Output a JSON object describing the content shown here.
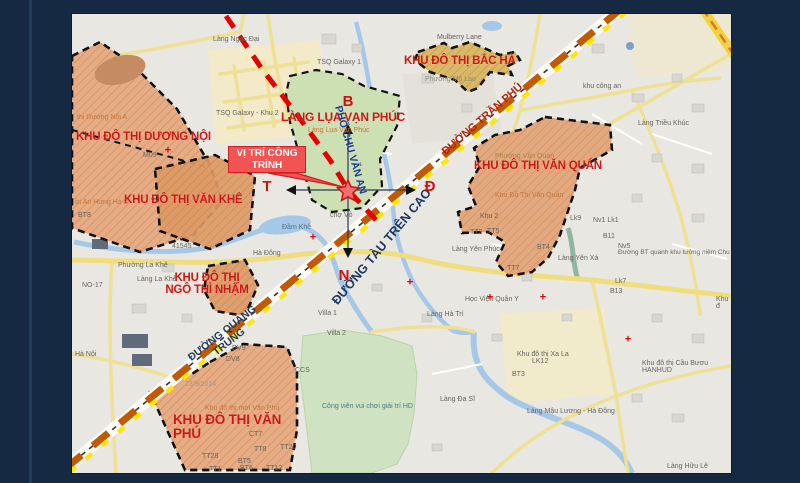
{
  "slide": {
    "background_color": "#152a42"
  },
  "map": {
    "base_color": "#e9e7e1",
    "zone_fill": "#e5a87e",
    "zone_fill_dark": "#dd9a66",
    "bacha_fill": "#d9b55e",
    "green_zone_fill": "#cde0b4",
    "highway_orange": "#c25a04",
    "highway_yellow": "#ffe60a",
    "red_road": "#e60000",
    "water": "#a6c8e8"
  },
  "callout": {
    "line1": "VỊ TRÍ CÔNG",
    "line2": "TRÌNH",
    "bg": "#f25353",
    "border": "#cf1f1f"
  },
  "compass": [
    {
      "text": "B",
      "x": 276,
      "y": 88
    },
    {
      "text": "T",
      "x": 195,
      "y": 173
    },
    {
      "text": "Đ",
      "x": 358,
      "y": 173
    },
    {
      "text": "N",
      "x": 272,
      "y": 262
    }
  ],
  "zone_labels": [
    {
      "name": "zone-label-duong-noi",
      "text": "KHU ĐÔ THỊ DƯƠNG NỘI",
      "x": 4,
      "y": 117
    },
    {
      "name": "zone-label-van-khe",
      "text": "KHU ĐÔ THỊ VĂN KHÊ",
      "x": 52,
      "y": 180
    },
    {
      "name": "zone-label-ngo-thi-nham",
      "text": "KHU ĐÔ THỊ\nNGÔ THÌ NHẬM",
      "x": 85,
      "y": 258,
      "w": 100,
      "align": "center"
    },
    {
      "name": "zone-label-van-phu",
      "text": "KHU ĐÔ THỊ VĂN\nPHÚ",
      "x": 101,
      "y": 399,
      "size": 13.5
    },
    {
      "name": "zone-label-lang-lua-van-phuc",
      "text": "LÀNG LỤA VẠN PHÚC",
      "x": 209,
      "y": 97,
      "size": 12
    },
    {
      "name": "zone-label-bac-ha",
      "text": "KHU ĐÔ THỊ BẮC HÀ",
      "x": 332,
      "y": 41
    },
    {
      "name": "zone-label-van-quan",
      "text": "KHU ĐÔ THỊ VĂN QUÁN",
      "x": 402,
      "y": 146
    }
  ],
  "road_labels": [
    {
      "name": "road-label-tran-phu",
      "text": "ĐƯỜNG TRẦN PHÚ",
      "x": 411,
      "y": 106,
      "rotate": -41,
      "color": "#b3220f",
      "size": 11
    },
    {
      "name": "road-label-tau-tren-cao",
      "text": "ĐƯỜNG TÀU TRÊN CAO",
      "x": 310,
      "y": 233,
      "rotate": -50,
      "color": "#1c3668",
      "size": 12.5
    },
    {
      "name": "road-label-quang-trung",
      "text": "ĐƯỜNG QUANG\nTRUNG",
      "x": 154,
      "y": 324,
      "rotate": -38,
      "color": "#233a5e",
      "size": 10.5
    },
    {
      "name": "road-label-chu-van-an",
      "text": "PHỐ CHU VĂN AN",
      "x": 278,
      "y": 136,
      "rotate": 74,
      "color": "#1d3f94",
      "size": 10.5
    }
  ],
  "place_labels": [
    {
      "text": "Làng Ngọc Đại",
      "x": 141,
      "y": 22
    },
    {
      "text": "Mulberry Lane",
      "x": 365,
      "y": 20
    },
    {
      "text": "TSQ Galaxy 1",
      "x": 245,
      "y": 45
    },
    {
      "text": "TSQ Galaxy - Khu 2",
      "x": 144,
      "y": 96
    },
    {
      "text": "Phường Mộ Lao",
      "x": 353,
      "y": 62,
      "color": "#8a8a80"
    },
    {
      "text": "khu công an",
      "x": 511,
      "y": 69
    },
    {
      "text": "Làng Triều Khúc",
      "x": 566,
      "y": 106
    },
    {
      "text": "thị Dương Nội A",
      "x": 5,
      "y": 100,
      "color": "#c4763a"
    },
    {
      "text": "M09",
      "x": 71,
      "y": 138
    },
    {
      "text": "ời An Hưng Hà Đ",
      "x": 3,
      "y": 185,
      "color": "#c4763a"
    },
    {
      "text": "BT8",
      "x": 6,
      "y": 198
    },
    {
      "text": "41545",
      "x": 100,
      "y": 229
    },
    {
      "text": "Phường La Khê",
      "x": 46,
      "y": 248
    },
    {
      "text": "Làng La Khê",
      "x": 65,
      "y": 262
    },
    {
      "text": "NO-17",
      "x": 10,
      "y": 268
    },
    {
      "text": "Hà Đông",
      "x": 181,
      "y": 236
    },
    {
      "text": "Đầm Khê",
      "x": 210,
      "y": 210,
      "color": "#56718a"
    },
    {
      "text": "chợ Vồ",
      "x": 258,
      "y": 198
    },
    {
      "text": "Hà Nội",
      "x": 3,
      "y": 337
    },
    {
      "text": "23/9/2014",
      "x": 113,
      "y": 367,
      "color": "#9a9a94"
    },
    {
      "text": "Villa 1",
      "x": 246,
      "y": 296
    },
    {
      "text": "Villa 2",
      "x": 255,
      "y": 316
    },
    {
      "text": "CCS",
      "x": 223,
      "y": 353
    },
    {
      "text": "DV9",
      "x": 160,
      "y": 331
    },
    {
      "text": "DV8",
      "x": 154,
      "y": 342
    },
    {
      "text": "Khu đô thị mới Văn Phú",
      "x": 133,
      "y": 391,
      "color": "#c4763a"
    },
    {
      "text": "CT7",
      "x": 177,
      "y": 417
    },
    {
      "text": "TT8",
      "x": 182,
      "y": 432
    },
    {
      "text": "TT20",
      "x": 208,
      "y": 430
    },
    {
      "text": "TT28",
      "x": 130,
      "y": 439
    },
    {
      "text": "BT5",
      "x": 166,
      "y": 444
    },
    {
      "text": "BT6",
      "x": 168,
      "y": 451
    },
    {
      "text": "TT12",
      "x": 194,
      "y": 451
    },
    {
      "text": "TT1",
      "x": 137,
      "y": 452
    },
    {
      "text": "Công viên vui chơi giải trí HD",
      "x": 250,
      "y": 389,
      "color": "#4a7a8c"
    },
    {
      "text": "Làng Đa Sĩ",
      "x": 368,
      "y": 382
    },
    {
      "text": "Khu đô thị Xa La",
      "x": 445,
      "y": 337
    },
    {
      "text": "LK12",
      "x": 460,
      "y": 344
    },
    {
      "text": "BT3",
      "x": 440,
      "y": 357
    },
    {
      "text": "Khu đô thị Cầu Bươu HANHUD",
      "x": 570,
      "y": 346
    },
    {
      "text": "Làng Mậu Lương - Hà Đông",
      "x": 455,
      "y": 394
    },
    {
      "text": "Làng Hữu Lê",
      "x": 595,
      "y": 449
    },
    {
      "text": "Học Viện Quân Y",
      "x": 393,
      "y": 282
    },
    {
      "text": "Làng Hà Trì",
      "x": 355,
      "y": 297
    },
    {
      "text": "Làng Yên Phúc",
      "x": 380,
      "y": 232
    },
    {
      "text": "Làng Yên Xá",
      "x": 486,
      "y": 241
    },
    {
      "text": "Lk9",
      "x": 498,
      "y": 201
    },
    {
      "text": "Nv1  Lk1",
      "x": 521,
      "y": 203
    },
    {
      "text": "B11",
      "x": 531,
      "y": 219
    },
    {
      "text": "Nv5",
      "x": 546,
      "y": 229
    },
    {
      "text": "Đường BT quanh khu tưởng niệm Chu",
      "x": 546,
      "y": 236,
      "size": 6.5
    },
    {
      "text": "Lk7",
      "x": 543,
      "y": 264
    },
    {
      "text": "B13",
      "x": 538,
      "y": 274
    },
    {
      "text": "Khu đ",
      "x": 644,
      "y": 282
    },
    {
      "text": "Phường Văn Quán",
      "x": 423,
      "y": 139,
      "color": "#b08048"
    },
    {
      "text": "Khu Đô Thị Văn Quán",
      "x": 423,
      "y": 178,
      "color": "#c4763a"
    },
    {
      "text": "Khu 2",
      "x": 408,
      "y": 199
    },
    {
      "text": "TT3",
      "x": 398,
      "y": 215
    },
    {
      "text": "TT5",
      "x": 415,
      "y": 214
    },
    {
      "text": "BT4",
      "x": 465,
      "y": 230
    },
    {
      "text": "TT7",
      "x": 435,
      "y": 251
    },
    {
      "text": "Làng Lụa Vạn Phúc",
      "x": 236,
      "y": 113,
      "color": "#c4763a"
    }
  ],
  "crosses": [
    {
      "x": 96,
      "y": 137
    },
    {
      "x": 241,
      "y": 224
    },
    {
      "x": 338,
      "y": 269
    },
    {
      "x": 418,
      "y": 284
    },
    {
      "x": 471,
      "y": 284
    },
    {
      "x": 556,
      "y": 326
    }
  ]
}
